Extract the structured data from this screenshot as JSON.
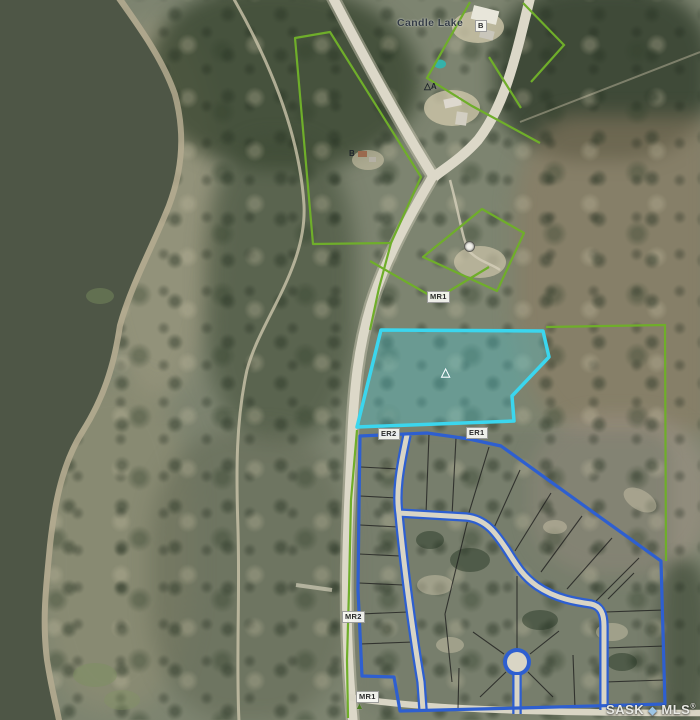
{
  "map": {
    "place_label": "Candle Lake",
    "parcel_labels": {
      "mr1_top": "MR1",
      "er2": "ER2",
      "er1": "ER1",
      "mr2": "MR2",
      "mr1_bottom": "MR1"
    },
    "markers": {
      "b_top": "B",
      "a_top_symbol": "△",
      "a_top": "A",
      "b_mid": "B",
      "highlight_triangle": "△",
      "bottom_triangle": "▲"
    },
    "watermark": {
      "brand": "SASK",
      "separator": "◆",
      "brand2": "MLS",
      "registered": "®"
    },
    "legend_colors": {
      "highlighted_parcel_border": "#3BD6EE",
      "highlighted_parcel_fill": "rgba(70,200,215,0.33)",
      "parcel_outline_green": "#6FAE2A",
      "subdivision_boundary_blue": "#2E5FD0",
      "road_surface": "#DCD8C8",
      "lake_water": "#4E5646"
    }
  }
}
